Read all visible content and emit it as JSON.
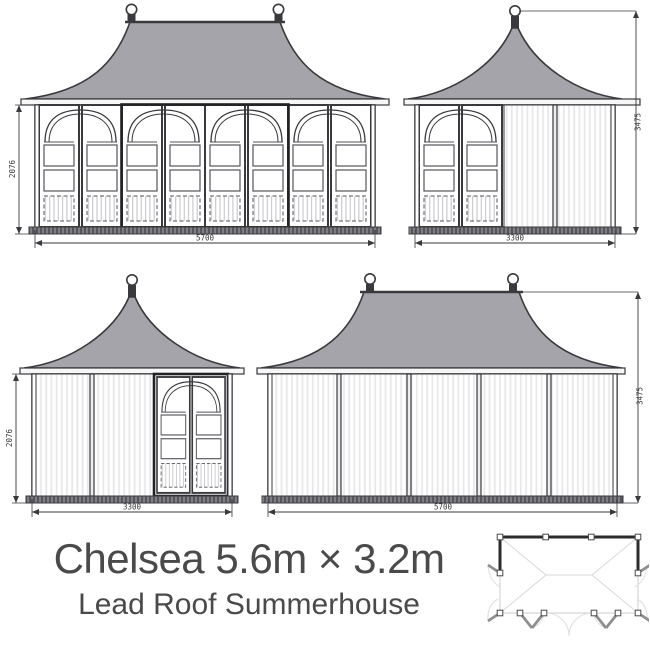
{
  "title": {
    "main": "Chelsea 5.6m × 3.2m",
    "sub": "Lead Roof Summerhouse"
  },
  "views": {
    "front_elevation": {
      "width_dim": "5700",
      "height_dim": "2076"
    },
    "right_side_elevation": {
      "width_dim": "3300",
      "height_dim": "3475"
    },
    "left_side_elevation": {
      "width_dim": "3300",
      "height_dim": "2076"
    },
    "rear_elevation": {
      "width_dim": "5700",
      "height_dim": "3475"
    }
  },
  "colors": {
    "roof": "#a4a4aa",
    "line": "#3a3a3e",
    "title_text": "#4a4a4a"
  }
}
